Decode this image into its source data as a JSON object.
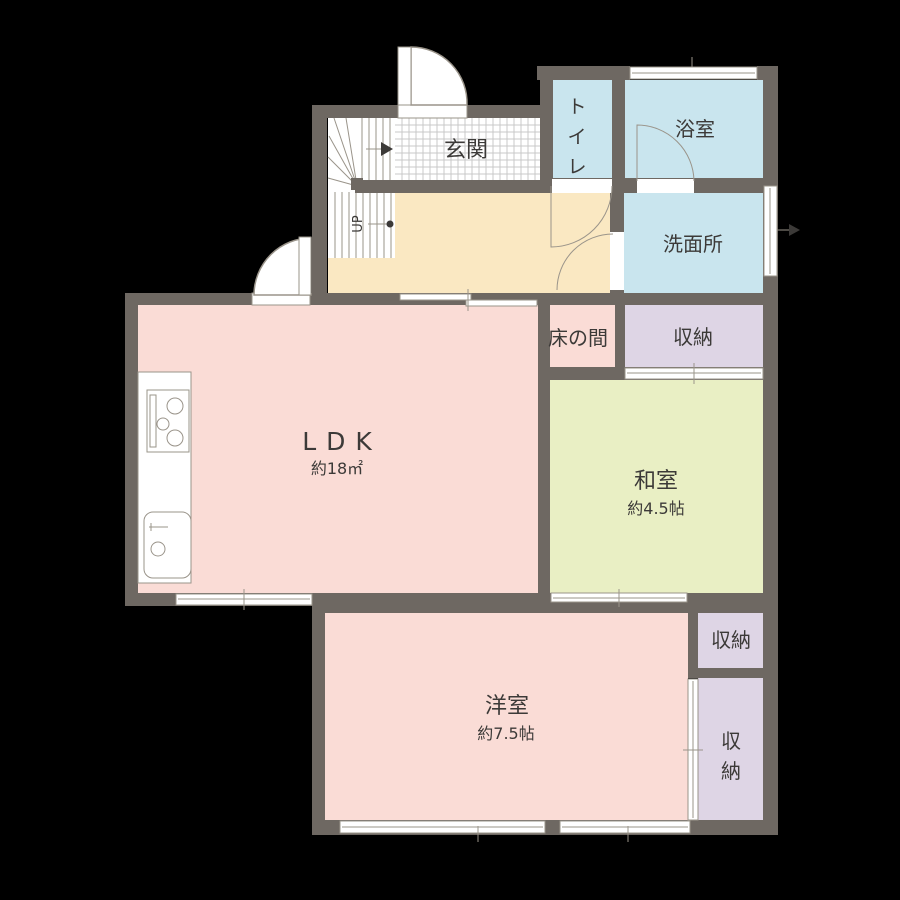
{
  "plan": {
    "type": "japanese-apartment-floor-plan",
    "floor_note": "1F"
  },
  "colors": {
    "background": "#000000",
    "wall": "#6e6862",
    "room_pink": "#fadcd6",
    "room_cream": "#fae8c2",
    "room_blue": "#c9e5ee",
    "room_green": "#e9efc4",
    "room_purple": "#ded5e5",
    "floor_white": "#ffffff",
    "line": "#9a948a",
    "grid": "#c9c9c9",
    "text": "#3c3a38"
  },
  "rooms": {
    "genkan": {
      "label": "玄関"
    },
    "stairs": {
      "label": "UP"
    },
    "toilet": {
      "label": "トイレ",
      "chars": [
        "ト",
        "イ",
        "レ"
      ]
    },
    "bathroom": {
      "label": "浴室"
    },
    "washroom": {
      "label": "洗面所"
    },
    "tokonoma": {
      "label": "床の間"
    },
    "storage_top": {
      "label": "収納"
    },
    "ldk": {
      "label": "LDK",
      "area": "約18㎡"
    },
    "washitsu": {
      "label": "和室",
      "area": "約4.5帖"
    },
    "youshitsu": {
      "label": "洋室",
      "area": "約7.5帖"
    },
    "storage_mid": {
      "label": "収納"
    },
    "storage_bottom": {
      "label": "収納",
      "chars": [
        "収",
        "納"
      ]
    }
  }
}
